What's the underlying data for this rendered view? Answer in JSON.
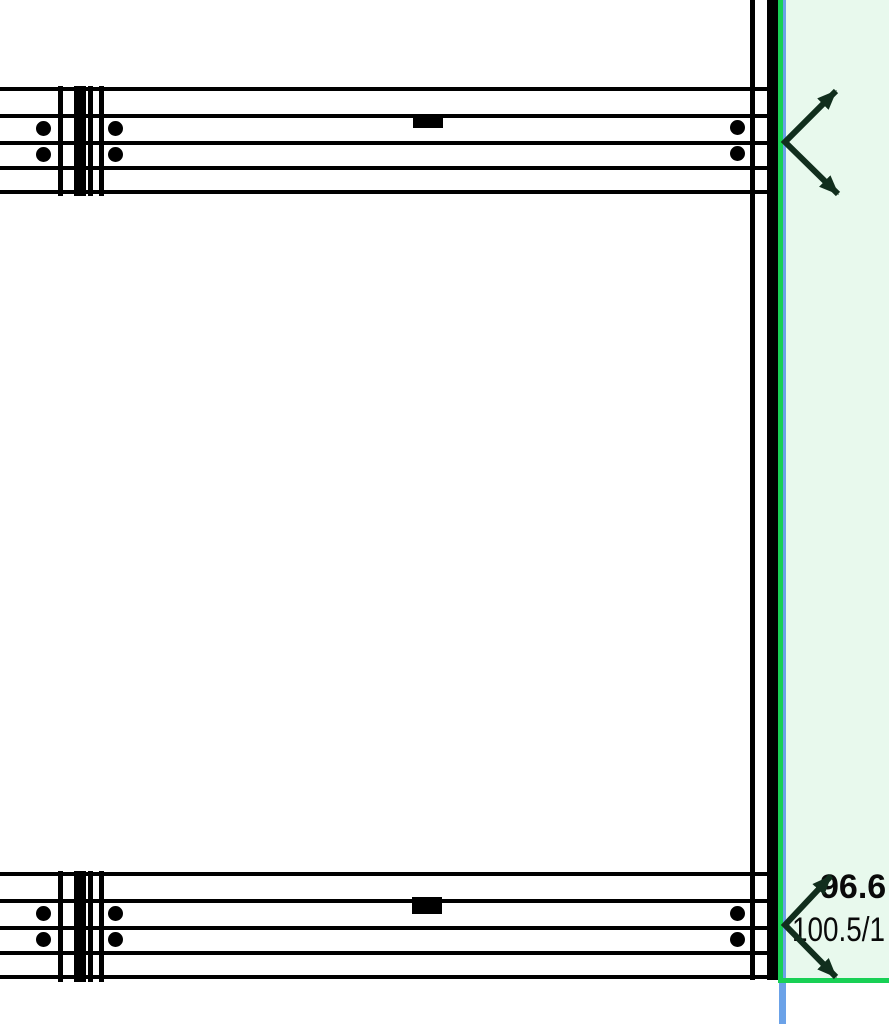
{
  "canvas": {
    "width": 889,
    "height": 1024,
    "background": "#ffffff"
  },
  "colors": {
    "ink": "#000000",
    "accent_green": "#18d055",
    "accent_blue": "#6ba2e8",
    "panel_mint": "#e8f9ed",
    "annotation_dark": "#112e1d",
    "label_ink": "#0a0a0a"
  },
  "labels": {
    "dimension_primary": "96.6",
    "dimension_secondary": "100.5/1"
  },
  "geometry": {
    "rects": [
      {
        "name": "highlight-panel",
        "x": 786,
        "y": 0,
        "w": 103,
        "h": 978,
        "color": "panel_mint"
      },
      {
        "name": "axis-line-blue-vertical",
        "x": 778.5,
        "y": 0,
        "w": 7.5,
        "h": 1024,
        "color": "accent_blue"
      },
      {
        "name": "grid-line-green-vertical",
        "x": 778,
        "y": 0,
        "w": 5,
        "h": 980,
        "color": "accent_green"
      },
      {
        "name": "wall-line-thin-right",
        "x": 750,
        "y": 0,
        "w": 5,
        "h": 980,
        "color": "ink"
      },
      {
        "name": "wall-post-thick-right",
        "x": 767,
        "y": 0,
        "w": 11,
        "h": 980,
        "color": "ink"
      },
      {
        "name": "grid-line-green-horizontal",
        "x": 778,
        "y": 978,
        "w": 111,
        "h": 4.6,
        "color": "accent_green"
      },
      {
        "name": "top-beam-line-1",
        "x": 0,
        "y": 87,
        "w": 770,
        "h": 4,
        "color": "ink"
      },
      {
        "name": "top-beam-line-2",
        "x": 0,
        "y": 114,
        "w": 770,
        "h": 4,
        "color": "ink"
      },
      {
        "name": "top-beam-line-3",
        "x": 0,
        "y": 141,
        "w": 770,
        "h": 4,
        "color": "ink"
      },
      {
        "name": "top-beam-line-4",
        "x": 0,
        "y": 166,
        "w": 770,
        "h": 4,
        "color": "ink"
      },
      {
        "name": "top-beam-line-5",
        "x": 0,
        "y": 190,
        "w": 770,
        "h": 4,
        "color": "ink"
      },
      {
        "name": "bottom-beam-line-1",
        "x": 0,
        "y": 872,
        "w": 770,
        "h": 4,
        "color": "ink"
      },
      {
        "name": "bottom-beam-line-2",
        "x": 0,
        "y": 899,
        "w": 770,
        "h": 4,
        "color": "ink"
      },
      {
        "name": "bottom-beam-line-3",
        "x": 0,
        "y": 926,
        "w": 770,
        "h": 4,
        "color": "ink"
      },
      {
        "name": "bottom-beam-line-4",
        "x": 0,
        "y": 951,
        "w": 770,
        "h": 4,
        "color": "ink"
      },
      {
        "name": "bottom-beam-line-5",
        "x": 0,
        "y": 975,
        "w": 770,
        "h": 4,
        "color": "ink"
      },
      {
        "name": "top-splice-line-a",
        "x": 58,
        "y": 86,
        "w": 5,
        "h": 110,
        "color": "ink"
      },
      {
        "name": "top-splice-post",
        "x": 74,
        "y": 86,
        "w": 12,
        "h": 110,
        "color": "ink"
      },
      {
        "name": "top-splice-line-b",
        "x": 88,
        "y": 86,
        "w": 5,
        "h": 110,
        "color": "ink"
      },
      {
        "name": "top-splice-line-c",
        "x": 99,
        "y": 86,
        "w": 5,
        "h": 110,
        "color": "ink"
      },
      {
        "name": "bottom-splice-line-a",
        "x": 58,
        "y": 871,
        "w": 5,
        "h": 111,
        "color": "ink"
      },
      {
        "name": "bottom-splice-post",
        "x": 74,
        "y": 871,
        "w": 12,
        "h": 111,
        "color": "ink"
      },
      {
        "name": "bottom-splice-line-b",
        "x": 88,
        "y": 871,
        "w": 5,
        "h": 111,
        "color": "ink"
      },
      {
        "name": "bottom-splice-line-c",
        "x": 99,
        "y": 871,
        "w": 5,
        "h": 111,
        "color": "ink"
      },
      {
        "name": "top-beam-plate",
        "x": 413,
        "y": 114,
        "w": 30,
        "h": 14,
        "color": "ink"
      },
      {
        "name": "bottom-beam-plate",
        "x": 412,
        "y": 897,
        "w": 30,
        "h": 17,
        "color": "ink"
      }
    ],
    "dots": [
      {
        "name": "top-beam-bolt",
        "cx": 43,
        "cy": 128,
        "r": 7.5,
        "color": "ink"
      },
      {
        "name": "top-beam-bolt",
        "cx": 115,
        "cy": 128,
        "r": 7.5,
        "color": "ink"
      },
      {
        "name": "top-beam-bolt",
        "cx": 43,
        "cy": 154,
        "r": 7.5,
        "color": "ink"
      },
      {
        "name": "top-beam-bolt",
        "cx": 115,
        "cy": 154,
        "r": 7.5,
        "color": "ink"
      },
      {
        "name": "top-beam-bolt",
        "cx": 737,
        "cy": 127,
        "r": 7.5,
        "color": "ink"
      },
      {
        "name": "top-beam-bolt",
        "cx": 737,
        "cy": 153,
        "r": 7.5,
        "color": "ink"
      },
      {
        "name": "bottom-beam-bolt",
        "cx": 43,
        "cy": 913,
        "r": 7.5,
        "color": "ink"
      },
      {
        "name": "bottom-beam-bolt",
        "cx": 115,
        "cy": 913,
        "r": 7.5,
        "color": "ink"
      },
      {
        "name": "bottom-beam-bolt",
        "cx": 43,
        "cy": 939,
        "r": 7.5,
        "color": "ink"
      },
      {
        "name": "bottom-beam-bolt",
        "cx": 115,
        "cy": 939,
        "r": 7.5,
        "color": "ink"
      },
      {
        "name": "bottom-beam-bolt",
        "cx": 737,
        "cy": 913,
        "r": 7.5,
        "color": "ink"
      },
      {
        "name": "bottom-beam-bolt",
        "cx": 737,
        "cy": 939,
        "r": 7.5,
        "color": "ink"
      }
    ],
    "arrows": [
      {
        "name": "leader-arrows-top",
        "points": [
          [
            836,
            91
          ],
          [
            785,
            142
          ],
          [
            838,
            194
          ]
        ],
        "stroke_width": 6,
        "color": "annotation_dark"
      },
      {
        "name": "leader-arrows-bottom",
        "points": [
          [
            831,
            876
          ],
          [
            785,
            925
          ],
          [
            836,
            977
          ]
        ],
        "stroke_width": 6,
        "color": "annotation_dark"
      }
    ]
  }
}
